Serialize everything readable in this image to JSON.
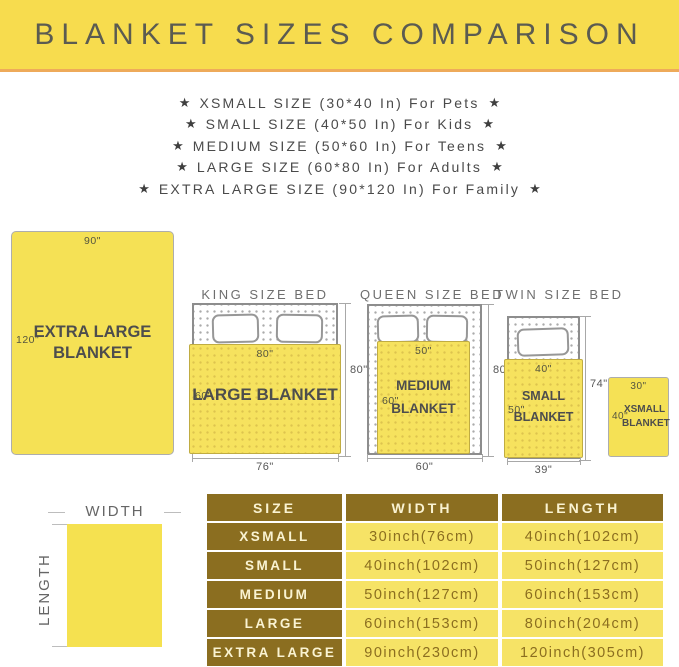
{
  "banner": {
    "title": "BLANKET SIZES COMPARISON"
  },
  "icons": {
    "star": "★"
  },
  "size_list": [
    "XSMALL SIZE (30*40 In) For Pets",
    "SMALL SIZE (40*50 In) For Kids",
    "MEDIUM SIZE (50*60 In) For Teens",
    "LARGE SIZE (60*80 In) For Adults",
    "EXTRA LARGE SIZE (90*120 In) For Family"
  ],
  "diagram": {
    "extra_large": {
      "width": "90\"",
      "length": "120\"",
      "name1": "EXTRA LARGE",
      "name2": "BLANKET"
    },
    "king": {
      "title": "KING SIZE BED",
      "blanket_name": "LARGE BLANKET",
      "blanket_top": "80\"",
      "blanket_side": "60\"",
      "bed_width": "76\"",
      "bed_height": "80\""
    },
    "queen": {
      "title": "QUEEN SIZE BED",
      "name1": "MEDIUM",
      "name2": "BLANKET",
      "blanket_top": "50\"",
      "blanket_side": "60\"",
      "bed_width": "60\"",
      "bed_height": "80\""
    },
    "twin": {
      "title": "TWIN SIZE BED",
      "name1": "SMALL",
      "name2": "BLANKET",
      "blanket_top": "40\"",
      "blanket_side": "50\"",
      "bed_width": "39\"",
      "bed_height": "74\""
    },
    "xsmall": {
      "name1": "XSMALL",
      "name2": "BLANKET",
      "width": "30\"",
      "length": "40\""
    }
  },
  "legend": {
    "width": "WIDTH",
    "length": "LENGTH"
  },
  "table": {
    "headers": [
      "SIZE",
      "WIDTH",
      "LENGTH"
    ],
    "rows": [
      [
        "XSMALL",
        "30inch(76cm)",
        "40inch(102cm)"
      ],
      [
        "SMALL",
        "40inch(102cm)",
        "50inch(127cm)"
      ],
      [
        "MEDIUM",
        "50inch(127cm)",
        "60inch(153cm)"
      ],
      [
        "LARGE",
        "60inch(153cm)",
        "80inch(204cm)"
      ],
      [
        "EXTRA LARGE",
        "90inch(230cm)",
        "120inch(305cm)"
      ]
    ]
  },
  "colors": {
    "banner_yellow": "#f7dc4e",
    "accent_orange": "#eeaa5a",
    "blanket_yellow": "#f5e155",
    "table_dark": "#8b6e20",
    "table_light": "#f6e366"
  }
}
